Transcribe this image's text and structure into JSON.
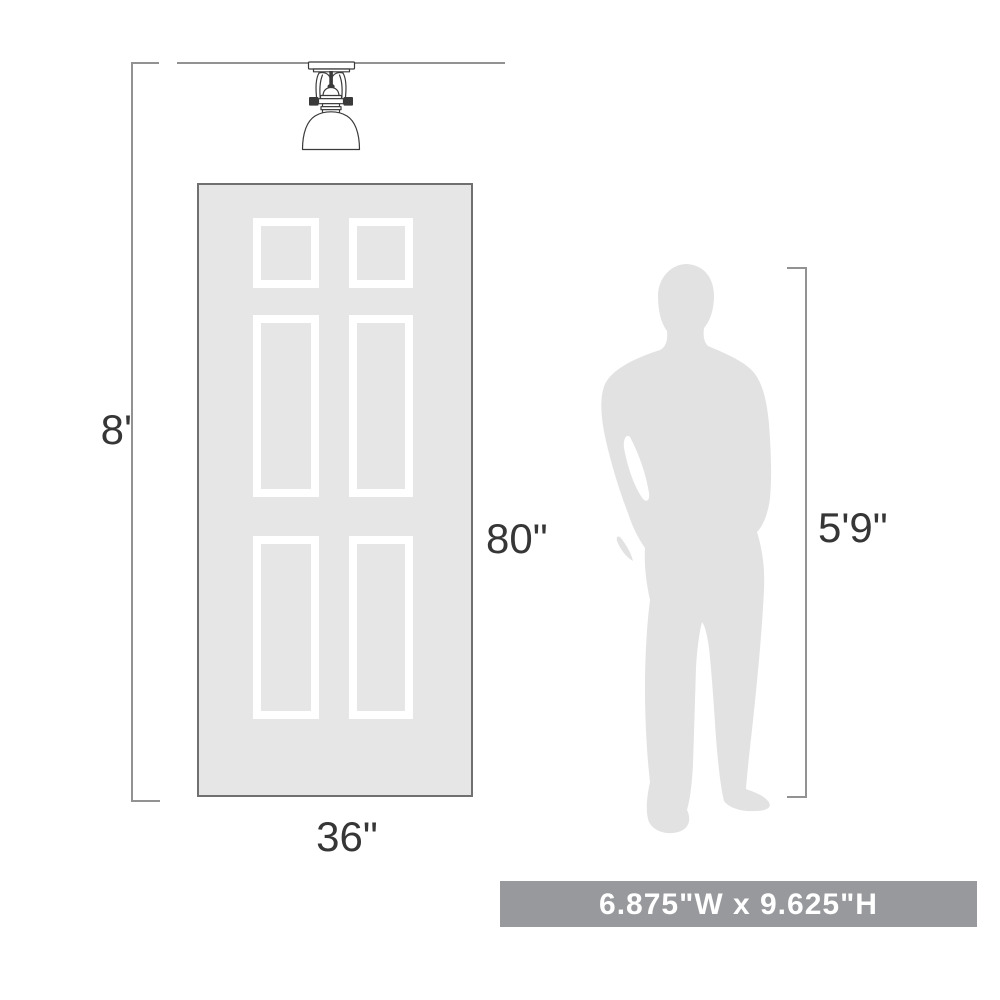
{
  "page": {
    "background": "#ffffff",
    "description": "Product scale diagram for a semi-flush mount ceiling light"
  },
  "labels": {
    "ceiling_height": "8'",
    "door_height": "80\"",
    "door_width": "36\"",
    "person_height": "5'9\"",
    "fixture_size": "6.875\"W x 9.625\"H"
  },
  "figures": {
    "fixture": "semi-flush-ceiling-light-icon",
    "door": "six-panel-door-illustration",
    "person": "male-silhouette-illustration"
  },
  "theme": {
    "page_bg": "#ffffff",
    "silhouette": "#e2e2e2",
    "door_fill": "#e6e6e6",
    "door_border": "#707070",
    "panel_border": "#ffffff",
    "dim_line": "#929292",
    "label_text": "#363636",
    "banner_bg": "#97999c",
    "banner_text": "#ffffff",
    "fixture_stroke": "#3a3a3a"
  }
}
